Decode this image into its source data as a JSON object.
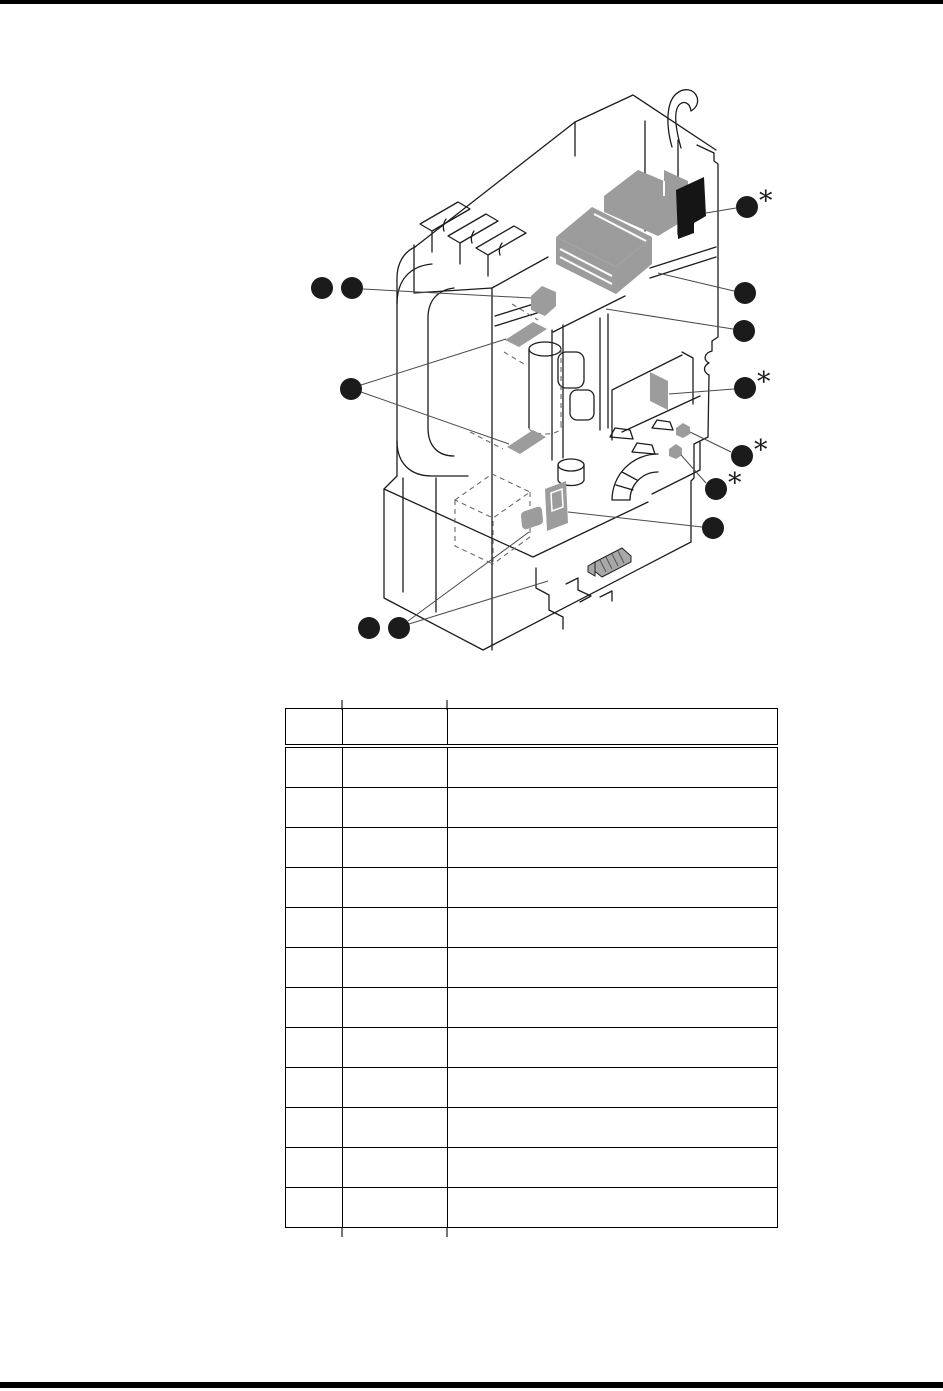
{
  "page": {
    "background": "#ffffff",
    "top_rule_color": "#000000",
    "bottom_rule_color": "#000000"
  },
  "figure": {
    "kind": "exploded-parts-illustration",
    "line_color": "#1c1c1c",
    "highlight_color": "#9c9c9c",
    "dark_part_color": "#151515",
    "callout_color": "#1b1b1b",
    "asterisk_marker": "*",
    "callout_radius": 11,
    "callouts": [
      {
        "id": "callout-1",
        "x": 747,
        "y": 207,
        "asterisk": true
      },
      {
        "id": "callout-2",
        "x": 322,
        "y": 288,
        "asterisk": false
      },
      {
        "id": "callout-3",
        "x": 352,
        "y": 288,
        "asterisk": false
      },
      {
        "id": "callout-4",
        "x": 745,
        "y": 293,
        "asterisk": false
      },
      {
        "id": "callout-5",
        "x": 744,
        "y": 331,
        "asterisk": false
      },
      {
        "id": "callout-6",
        "x": 745,
        "y": 388,
        "asterisk": true
      },
      {
        "id": "callout-7",
        "x": 351,
        "y": 389,
        "asterisk": false
      },
      {
        "id": "callout-8",
        "x": 742,
        "y": 456,
        "asterisk": true
      },
      {
        "id": "callout-9",
        "x": 716,
        "y": 489,
        "asterisk": true
      },
      {
        "id": "callout-10",
        "x": 713,
        "y": 528,
        "asterisk": false
      },
      {
        "id": "callout-11",
        "x": 369,
        "y": 628,
        "asterisk": false
      },
      {
        "id": "callout-12",
        "x": 399,
        "y": 628,
        "asterisk": false
      }
    ],
    "leader_lines": [
      [
        706,
        213,
        736,
        208
      ],
      [
        363,
        289,
        531,
        298
      ],
      [
        658,
        273,
        734,
        291
      ],
      [
        606,
        309,
        733,
        329
      ],
      [
        669,
        394,
        734,
        389
      ],
      [
        361,
        385,
        506,
        339
      ],
      [
        361,
        392,
        509,
        444
      ],
      [
        690,
        432,
        731,
        452
      ],
      [
        681,
        455,
        706,
        483
      ],
      [
        568,
        512,
        702,
        527
      ],
      [
        408,
        621,
        529,
        532
      ],
      [
        409,
        624,
        548,
        581
      ]
    ]
  },
  "table": {
    "columns": [
      {
        "label": "",
        "width": 57
      },
      {
        "label": "",
        "width": 105
      },
      {
        "label": "",
        "width": 330
      }
    ],
    "rows": [
      [
        "",
        "",
        ""
      ],
      [
        "",
        "",
        ""
      ],
      [
        "",
        "",
        ""
      ],
      [
        "",
        "",
        ""
      ],
      [
        "",
        "",
        ""
      ],
      [
        "",
        "",
        ""
      ],
      [
        "",
        "",
        ""
      ],
      [
        "",
        "",
        ""
      ],
      [
        "",
        "",
        ""
      ],
      [
        "",
        "",
        ""
      ],
      [
        "",
        "",
        ""
      ],
      [
        "",
        "",
        ""
      ]
    ]
  }
}
